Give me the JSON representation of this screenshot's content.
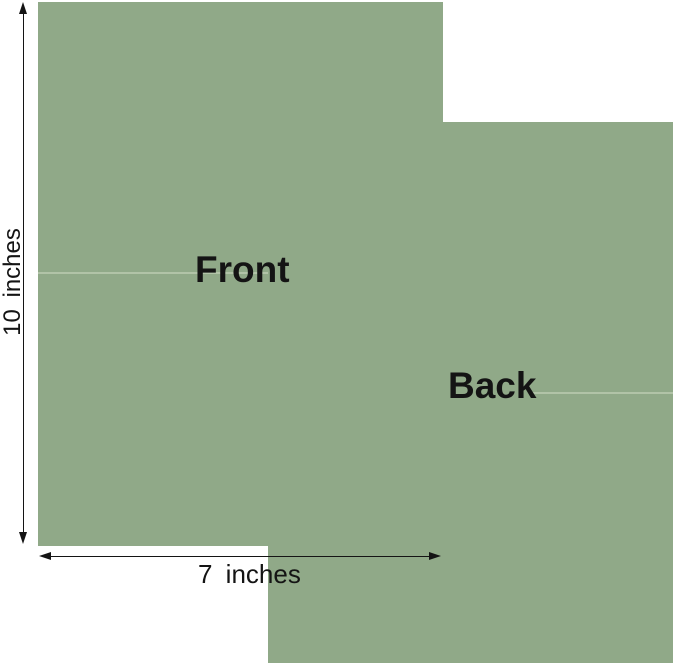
{
  "diagram": {
    "front_sheet_label": "Front",
    "back_sheet_label": "Back",
    "height_dimension_label": "10 inches",
    "width_dimension_label": "7 inches",
    "height_value_inches": 10,
    "width_value_inches": 7
  },
  "colors": {
    "paper-green": "#90a988",
    "crease": "#c8d6bc",
    "ink": "#141414",
    "background": "#ffffff"
  }
}
